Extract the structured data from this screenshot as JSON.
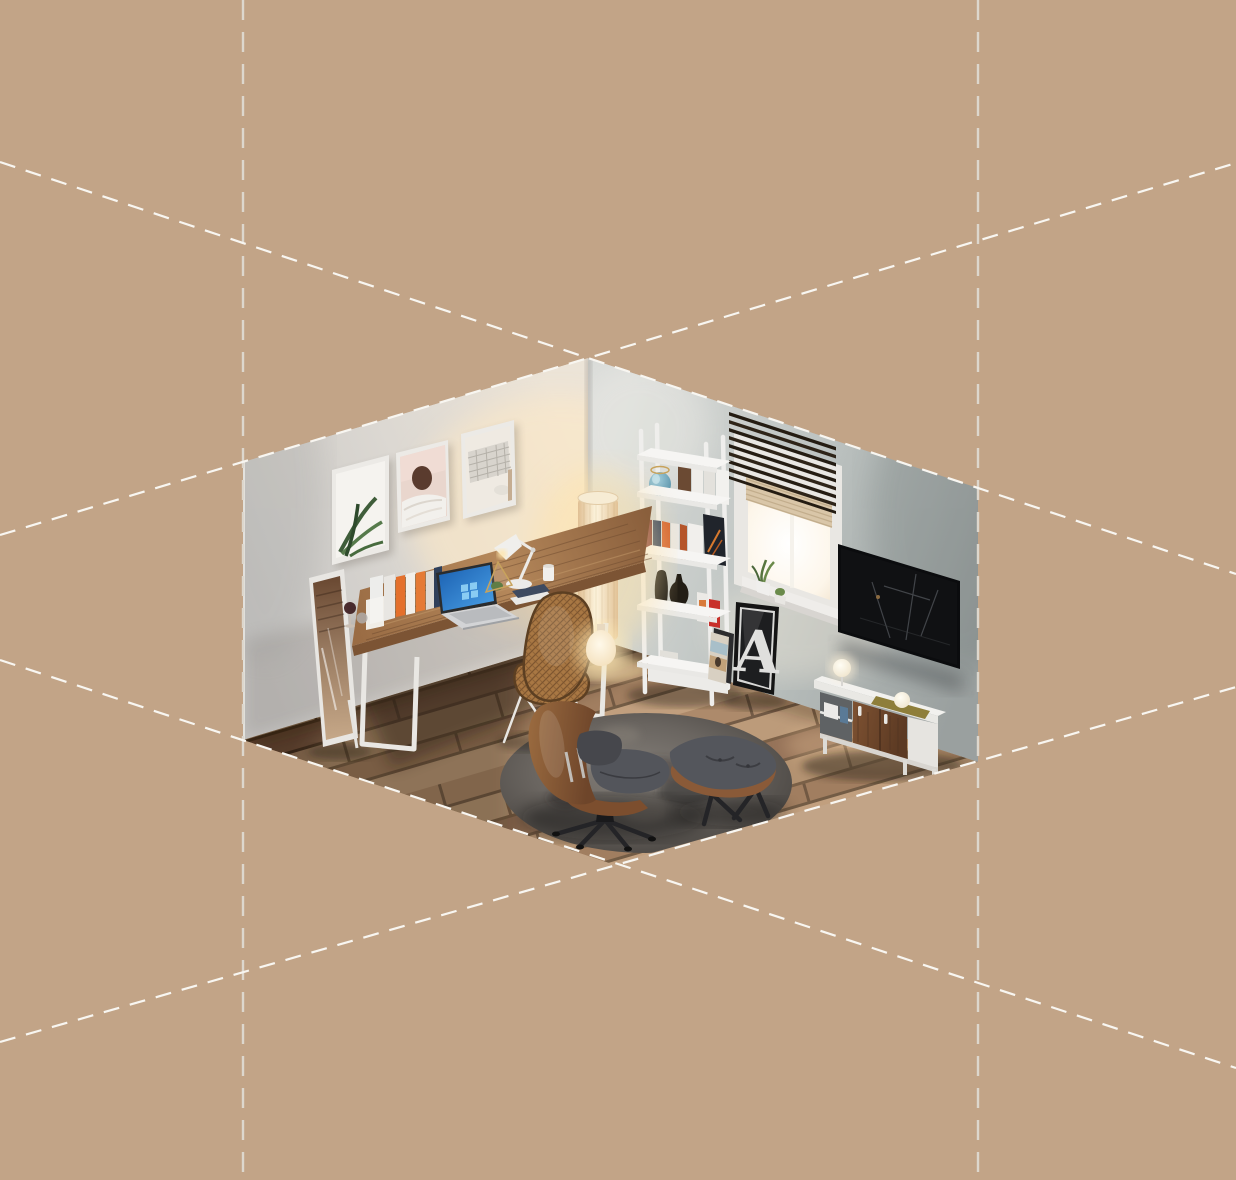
{
  "scene": {
    "title": "isometric-home-office-room",
    "background_color": "#c2a487",
    "grid": {
      "diagonal_line_color": "#f8f6f1",
      "vertical_line_color": "#ddd7cd",
      "style": "dashed isometric guides"
    },
    "poster": {
      "letter": "A"
    },
    "palette": {
      "left_wall": "#ddd8d1",
      "right_wall": "#b3b9b8",
      "floor_dark": "#4e3527",
      "floor_light": "#b79478",
      "rug": "#5c5752",
      "wood_accent": "#8a5a36",
      "teal_accent": "#6fa7bd",
      "red_accent": "#c8302a",
      "lamp_glow": "#ffe9c2",
      "laptop_screen_blue": "#2f7fd0",
      "tv_screen": "#0b0c0e"
    },
    "objects": [
      "wall-art-plant",
      "wall-art-portrait",
      "wall-art-keyboard",
      "standing-mirror",
      "wooden-desk",
      "laptop",
      "desk-lamp",
      "desk-books",
      "wire-chair",
      "floor-lamp",
      "ladder-shelf",
      "window-with-blinds",
      "letter-poster",
      "wall-tv",
      "tv-sideboard",
      "round-rug",
      "lounge-chair",
      "ottoman",
      "gourd-lamp"
    ]
  }
}
